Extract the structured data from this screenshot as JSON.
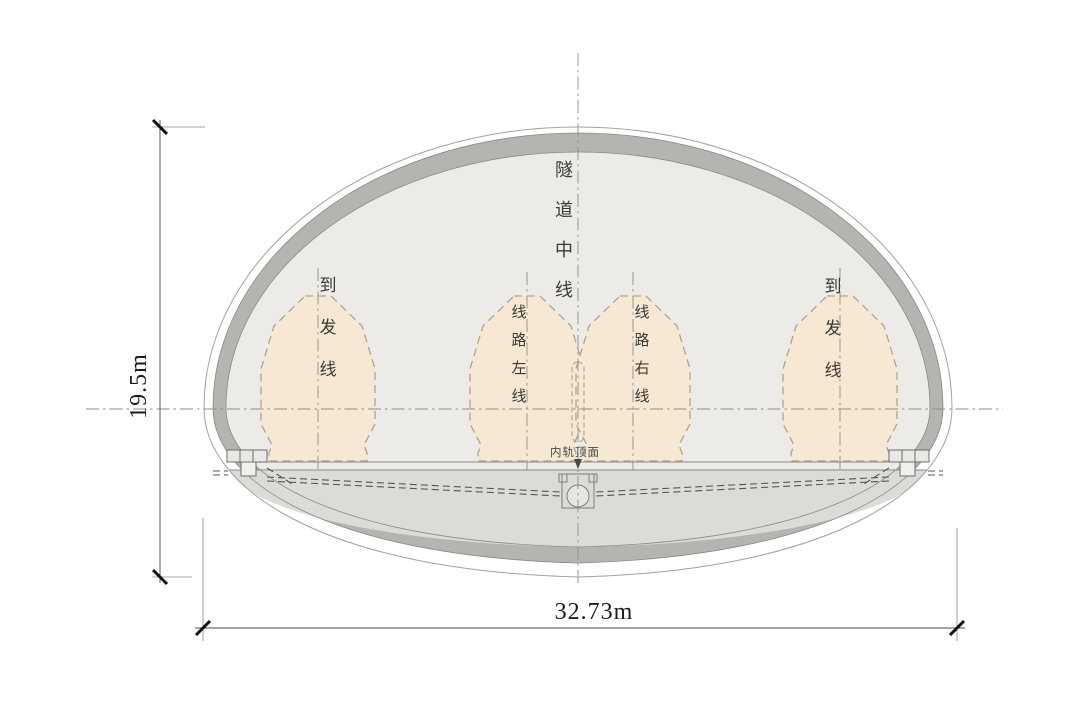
{
  "diagram": {
    "type": "tunnel-cross-section",
    "labels": {
      "tunnel_centerline": "隧道中线",
      "left_arrival_departure_track": "到发线",
      "route_left_line": "线路左线",
      "route_right_line": "线路右线",
      "right_arrival_departure_track": "到发线",
      "rail_top_surface": "内轨顶面"
    },
    "dimensions": {
      "height": "19.5m",
      "width": "32.73m"
    },
    "colors": {
      "background": "#ffffff",
      "lining": "#b5b4b1",
      "interior": "#edebe7",
      "under_floor": "#dcdbd7",
      "envelope_fill": "#f6e8d2",
      "envelope_border": "#b1a48e",
      "outline": "#8a8a88",
      "centerline": "#8f8e8a",
      "dimension": "#1c1c1c"
    }
  }
}
